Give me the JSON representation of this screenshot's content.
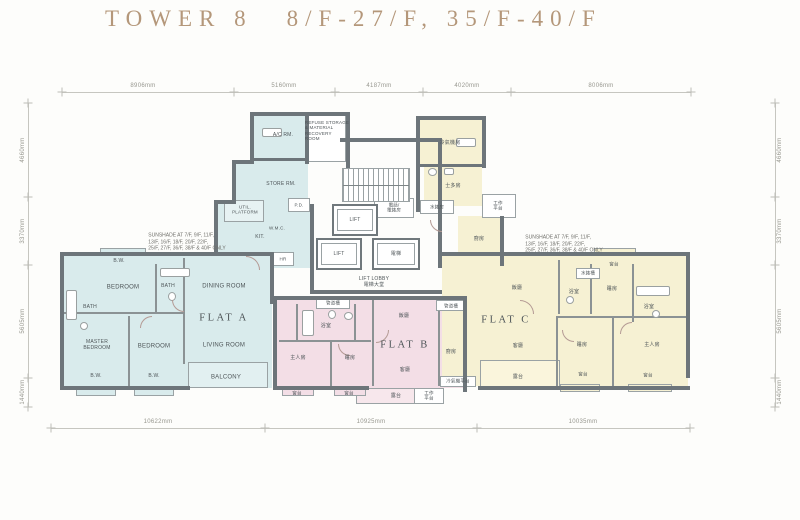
{
  "title": {
    "tower": "TOWER 8",
    "floors": "8/F-27/F, 35/F-40/F"
  },
  "dims": {
    "top": [
      "8906mm",
      "5160mm",
      "4187mm",
      "4020mm",
      "8006mm"
    ],
    "bottom": [
      "10622mm",
      "10925mm",
      "10035mm"
    ],
    "left": [
      "4660mm",
      "3370mm",
      "5605mm",
      "1440mm"
    ],
    "right": [
      "4660mm",
      "3370mm",
      "5605mm",
      "1440mm"
    ]
  },
  "notes": {
    "sunshade_left": "SUNSHADE AT 7/F, 9/F, 11/F,\n13/F, 16/F, 18/F, 20/F, 22/F,\n25/F, 27/F, 36/F, 38/F & 40/F ONLY",
    "sunshade_right": "SUNSHADE AT 7/F, 9/F, 11/F,\n13/F, 16/F, 18/F, 20/F, 22/F,\n25/F, 27/F, 36/F, 38/F & 40/F ONLY"
  },
  "core": {
    "refuse": "REFUSE STORAGE\n& MATERIAL\nRECOVERY\nROOM",
    "lift1": "LIFT",
    "lift2": "LIFT",
    "lift_cn": "電梯",
    "tel": "電話/\n電錶房",
    "lobby": "LIFT LOBBY\n電梯大堂",
    "water_meter": "水錶房"
  },
  "flat_a": {
    "name": "FLAT A",
    "rooms": {
      "ac": "A/C RM.",
      "store": "STORE RM.",
      "util": "UTIL.\nPLATFORM",
      "kit": "KIT.",
      "pd": "P.D.",
      "hr": "HR",
      "wmc": "W.M.C.",
      "bw_top": "B.W.",
      "bedroom1": "BEDROOM",
      "bath1": "BATH",
      "bath2": "BATH",
      "dining": "DINING ROOM",
      "master": "MASTER\nBEDROOM",
      "bedroom2": "BEDROOM",
      "living": "LIVING ROOM",
      "bw1": "B.W.",
      "bw2": "B.W.",
      "balcony": "BALCONY"
    }
  },
  "flat_b": {
    "name": "FLAT B",
    "rooms": {
      "duct1": "管道槽",
      "duct2": "管道槽",
      "bath": "浴室",
      "master": "主人房",
      "bedroom": "睡房",
      "dining": "飯廳",
      "living": "客廳",
      "kitchen": "廚房",
      "bw1": "窗台",
      "bw2": "窗台",
      "balcony": "露台",
      "util": "工作\n平台",
      "ac": "冷氣機平台"
    }
  },
  "flat_c": {
    "name": "FLAT C",
    "rooms": {
      "ac": "冷氣機房",
      "store": "士多房",
      "util": "工作\n平台",
      "kitchen": "廚房",
      "bw_top": "窗台",
      "dining": "飯廳",
      "living": "客廳",
      "balcony": "露台",
      "bath1": "浴室",
      "bath2": "浴室",
      "bedroom1": "睡房",
      "bedroom2": "睡房",
      "master": "主人房",
      "bw1": "窗台",
      "bw2": "窗台",
      "wmc": "水錶槽"
    }
  },
  "colors": {
    "flat_a": "#d9ebec",
    "flat_b": "#f3dee6",
    "flat_c": "#f6f1d3",
    "wall": "#6d757a",
    "title": "#b4977a"
  }
}
